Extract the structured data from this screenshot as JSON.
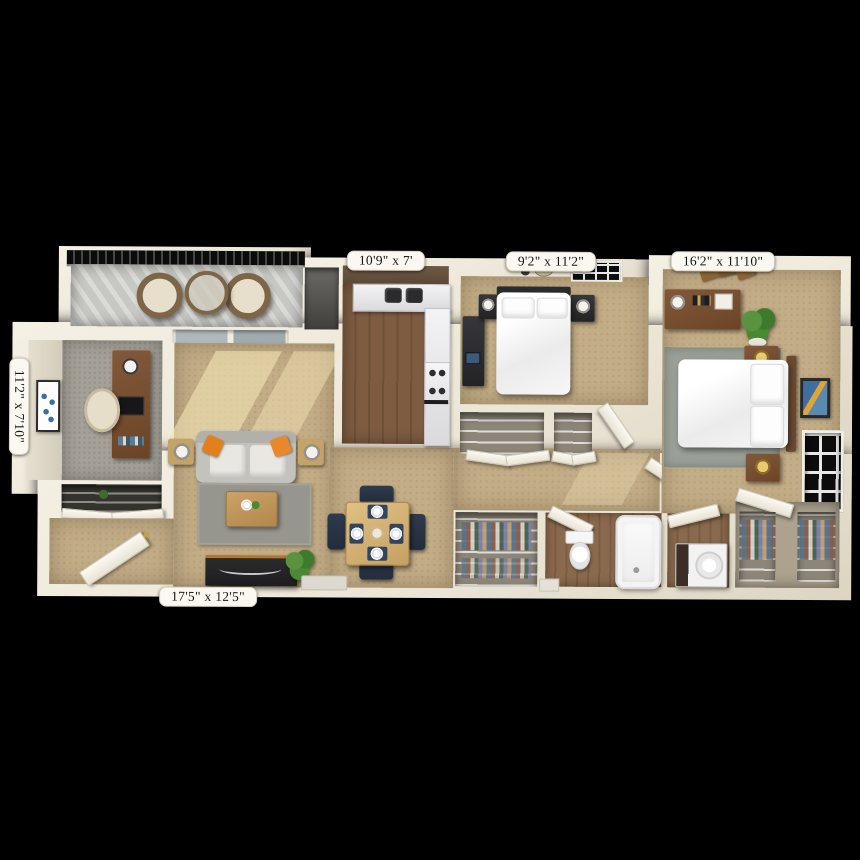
{
  "scene": {
    "description": "3D top-down apartment floor plan rendering on black background"
  },
  "dimension_labels": {
    "kitchen": "10'9\" x 7'",
    "bedroom_1": "9'2\" x 11'2\"",
    "bedroom_2": "16'2\" x 11'10\"",
    "den": "11'2\" x 7'10\"",
    "living_room": "17'5\" x 12'5\""
  },
  "colors": {
    "background": "#000000",
    "wall": "#ece6d7",
    "carpet_tan": "#c3ad87",
    "carpet_gray": "#a5a198",
    "wood_floor": "#7d5c42",
    "sofa_gray": "#cdcbc6",
    "accent_orange": "#e0811c",
    "plant_green": "#4b8834",
    "rug_gray": "#97968e",
    "dining_wood": "#d9b878",
    "chair_navy": "#2e3a4e",
    "label_bg": "#faf8f1",
    "label_text": "#141414"
  }
}
